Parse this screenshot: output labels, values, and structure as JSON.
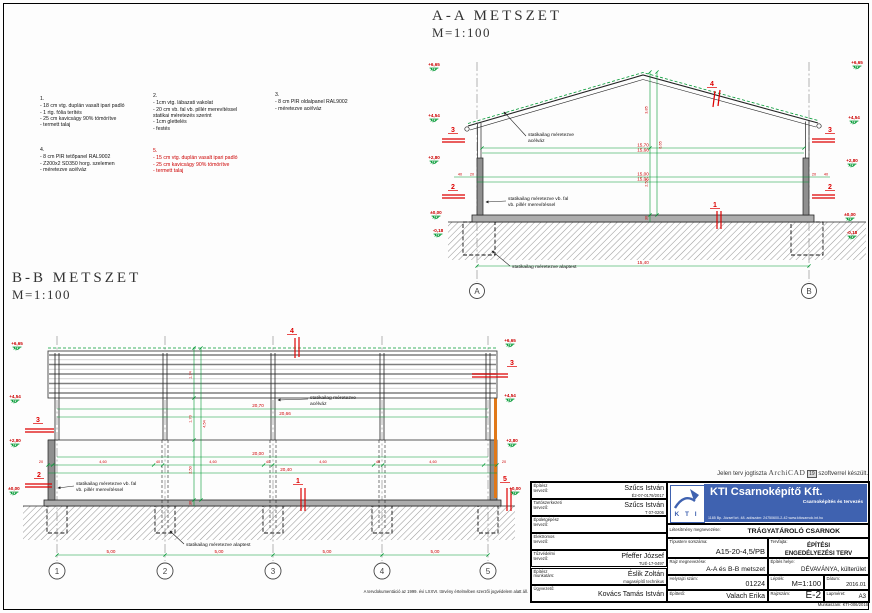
{
  "titles": {
    "aa_title": "A-A METSZET",
    "aa_scale": "M=1:100",
    "bb_title": "B-B METSZET",
    "bb_scale": "M=1:100"
  },
  "notes": [
    {
      "num": "1.",
      "lines": [
        "- 18 cm vtg. duplán vasalt ipari padló",
        "- 1 rtg. fólia terítés",
        "- 25 cm kavicságy 90% tömörítve",
        "- termett  talaj"
      ]
    },
    {
      "num": "2.",
      "lines": [
        "- 1cm vtg. lábazati  vakolat",
        "- 20 cm vb. fal vb. pillér merevítéssel",
        "   statikai  méretezés szerint",
        "- 1cm glettelés",
        "- festés"
      ]
    },
    {
      "num": "3.",
      "lines": [
        "- 8 cm PIR oldalpanel RAL9002",
        "- méretezve  acélváz"
      ]
    },
    {
      "num": "4.",
      "lines": [
        "- 8 cm PIR tetőpanel RAL9002",
        "- Z200x2 SD350 horg. szelemen",
        "- méretezve  acélváz"
      ]
    },
    {
      "num": "5.",
      "lines": [
        "- 15 cm vtg. duplán vasalt ipari padló",
        "- 25 cm kavicságy 90% tömörítve",
        "- termett  talaj"
      ]
    }
  ],
  "aa": {
    "dims": {
      "top1": "15,70",
      "top2": "15,66",
      "mid1": "15,00",
      "mid2": "15,06",
      "overall": "15,40",
      "w1": "40",
      "w2": "20",
      "w3": "20",
      "w4": "40"
    },
    "vdims": {
      "v1": "3,85",
      "v2": "6,65",
      "v3": "2,50",
      "v4": "30"
    },
    "levels_left": [
      "+6,65",
      "+4,54",
      "+2,80",
      "±0,00",
      "-0,18"
    ],
    "levels_right": [
      "+6,65",
      "+4,54",
      "+2,80",
      "±0,00",
      "-0,18"
    ],
    "grid": [
      "A",
      "B"
    ],
    "markers": {
      "m1": "1",
      "m2l": "2",
      "m2r": "2",
      "m3l": "3",
      "m3r": "3",
      "m4": "4"
    },
    "labels": {
      "roof1": "statikailag méretezve",
      "roof2": "acélváz",
      "wall1": "statikailag méretezve vb. fal",
      "wall2": "vb. pillér merevítéssel",
      "found": "statikailag méretezve alaptest"
    }
  },
  "bb": {
    "dims": {
      "top1": "20,70",
      "top2": "20,66",
      "clear": "20,00",
      "overall": "20,40"
    },
    "bay_dims": [
      "20",
      "4,60",
      "40",
      "4,60",
      "40",
      "4,60",
      "40",
      "4,60",
      "20"
    ],
    "grid_dims": [
      "5,00",
      "5,00",
      "5,00",
      "5,00"
    ],
    "vdims": {
      "v1": "1,74",
      "v2": "1,70",
      "v3": "2,50",
      "v4": "30",
      "v5": "4,54"
    },
    "levels_left": [
      "+6,65",
      "+4,54",
      "+2,80",
      "±0,00"
    ],
    "levels_right": [
      "+6,65",
      "+4,54",
      "+2,80",
      "+0,00"
    ],
    "grid": [
      "1",
      "2",
      "3",
      "4",
      "5"
    ],
    "markers": {
      "m1": "1",
      "m2": "2",
      "m3l": "3",
      "m3r": "3",
      "m4": "4",
      "m5": "5"
    },
    "labels": {
      "roof1": "statikailag méretezve",
      "roof2": "acélváz",
      "wall1": "statikailag méretezve vb. fal",
      "wall2": "vb. pillér merevítéssel",
      "found": "statikailag méretezve alaptest"
    }
  },
  "footer": {
    "copyright": "A tervdokumentáció az 1999. évi LXXVI. törvény értelmében szerzői jogvédelem alatt áll.",
    "archicad_pre": "Jelen terv jogtiszta",
    "archicad_logo": "ArchiCAD",
    "archicad_ver": "19",
    "archicad_post": "szoftverrel készült.",
    "workno": "Munkaszám: KTI-006/2016"
  },
  "titleblock": {
    "rows": [
      {
        "label1": "Építész",
        "label2": "tervező:",
        "name": "Szűcs István",
        "sub": "É2-07-0179/2017"
      },
      {
        "label1": "Tartószerkezeti",
        "label2": "tervező:",
        "name": "Szűcs István",
        "sub": "T 07-0206"
      },
      {
        "label1": "Épületgépész",
        "label2": "tervező:",
        "name": "",
        "sub": ""
      },
      {
        "label1": "Elektromos",
        "label2": "tervező:",
        "name": "",
        "sub": ""
      },
      {
        "label1": "Tűzvédelmi",
        "label2": "tervező:",
        "name": "Pfeffer József",
        "sub": "TUÉ-17-0497"
      },
      {
        "label1": "Építész",
        "label2": "munkatárs:",
        "name": "Éslik Zoltán",
        "sub": "magasépítő technikus"
      },
      {
        "label1": "Ügyvezető:",
        "label2": "",
        "name": "Kovács Tamás István",
        "sub": ""
      }
    ],
    "logo": {
      "kti": "K T I",
      "company": "KTI Csarnoképítő Kft.",
      "tagline": "Csarnoképítés és tervezés",
      "address": "1185 Bp. József krt. 48.   adószám: 24750600-2-42   www.kticsarnok.int.hu"
    },
    "facility_label": "Létesítmény megnevezése:",
    "facility": "TRÁGYATÁROLÓ CSARNOK",
    "type_label": "Típusterv sorszáma:",
    "type": "A15-20-4,5/PB",
    "kind_label": "Tervfajta:",
    "kind1": "ÉPÍTÉSI",
    "kind2": "ENGEDÉLYEZÉSI TERV",
    "drawing_label": "Rajz megnevezése:",
    "drawing": "A-A és B-B metszet",
    "site_label": "Építés helye:",
    "site": "DÉVAVÁNYA, külterület",
    "parcel_label": "Helyrajzi szám:",
    "parcel": "01224",
    "scale_label": "Lépték:",
    "scale": "M=1:100",
    "date_label": "Dátum:",
    "date": "2016.01",
    "client_label": "Építtető:",
    "client": "Valach Erika",
    "drawno_label": "Rajzszám:",
    "drawno": "E-2",
    "size_label": "Lapméret:",
    "size": "A3"
  }
}
